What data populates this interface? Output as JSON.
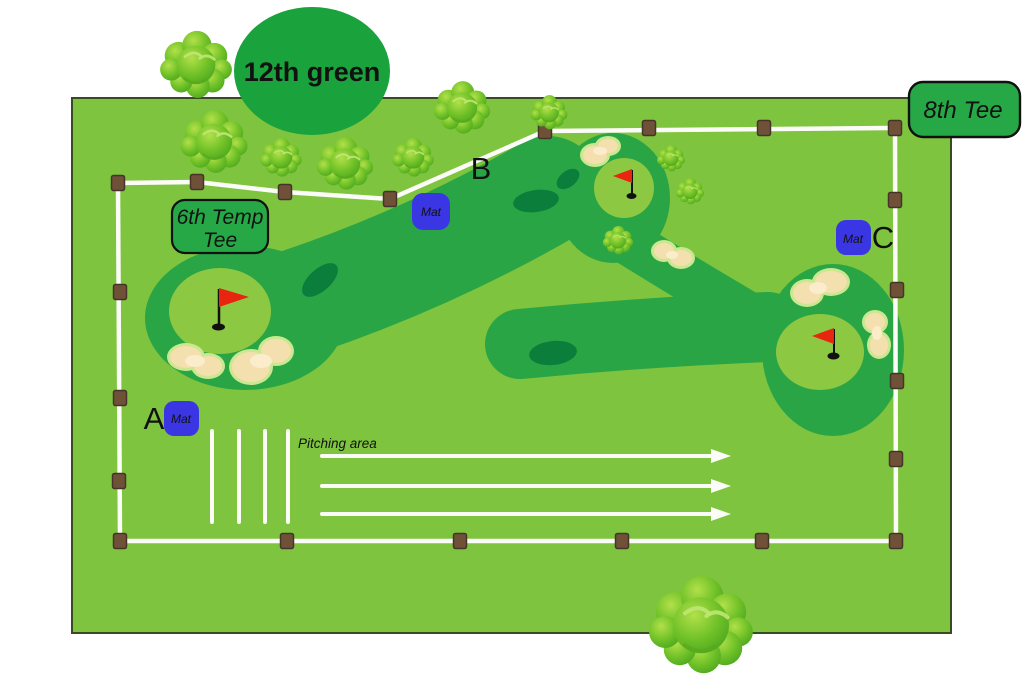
{
  "diagram": {
    "green12_label": "12th green",
    "tee8_label": "8th Tee",
    "tee6_line1": "6th Temp",
    "tee6_line2": "Tee",
    "pitching_label": "Pitching area",
    "mat_label": "Mat",
    "point_a": "A",
    "point_b": "B",
    "point_c": "C",
    "colors": {
      "field": "#7ec43e",
      "field_border": "#3a4a22",
      "fairway": "#2aa546",
      "putting_green": "#8dc843",
      "dark_patch": "#0b7e3c",
      "sand": "#f4dfae",
      "sand_light": "#fbeccb",
      "sand_halo": "#c9e88f",
      "label_ellipse": "#1aa23c",
      "tee_box": "#27a847",
      "mat_blue": "#3b36e4",
      "post_brown": "#6f5138",
      "post_border": "#46342a",
      "fence_white": "#fbfbf8",
      "flag_red": "#e8250f",
      "text_dark": "#111111"
    }
  }
}
